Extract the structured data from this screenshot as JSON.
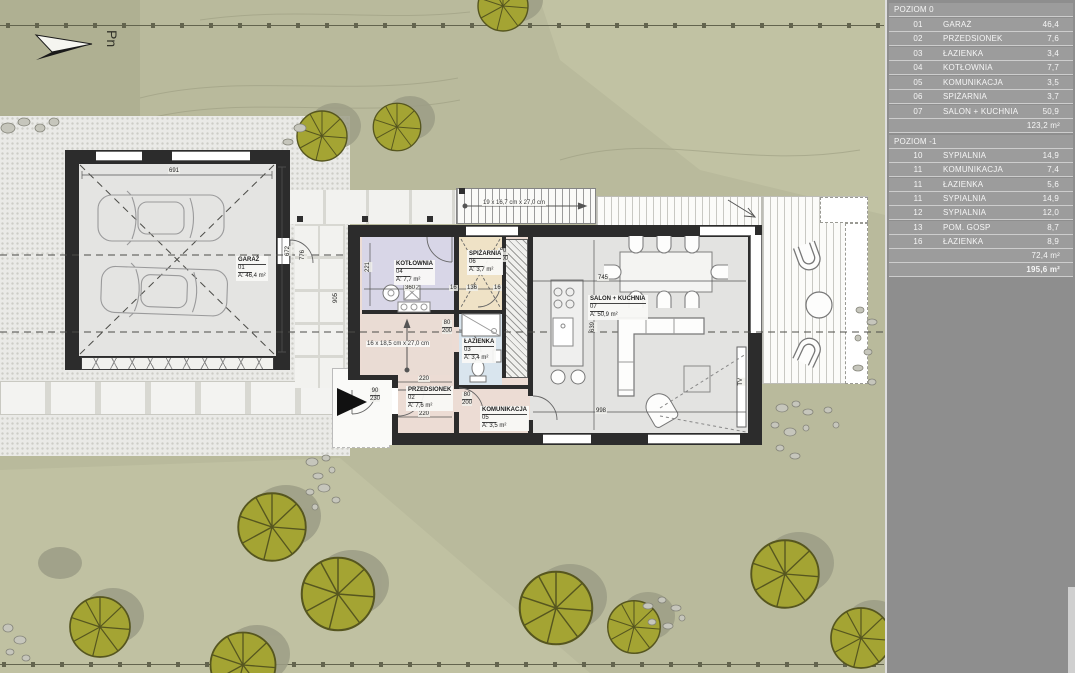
{
  "north": {
    "label": "Pn"
  },
  "legend": {
    "level0": {
      "title": "POZIOM 0",
      "rows": [
        {
          "no": "01",
          "name": "GARAŻ",
          "area": "46,4"
        },
        {
          "no": "02",
          "name": "PRZEDSIONEK",
          "area": "7,6"
        },
        {
          "no": "03",
          "name": "ŁAZIENKA",
          "area": "3,4"
        },
        {
          "no": "04",
          "name": "KOTŁOWNIA",
          "area": "7,7"
        },
        {
          "no": "05",
          "name": "KOMUNIKACJA",
          "area": "3,5"
        },
        {
          "no": "06",
          "name": "SPIŻARNIA",
          "area": "3,7"
        },
        {
          "no": "07",
          "name": "SALON + KUCHNIA",
          "area": "50,9"
        }
      ],
      "total": "123,2 m²"
    },
    "level_minus1": {
      "title": "POZIOM -1",
      "rows": [
        {
          "no": "10",
          "name": "SYPIALNIA",
          "area": "14,9"
        },
        {
          "no": "11",
          "name": "KOMUNIKACJA",
          "area": "7,4"
        },
        {
          "no": "11",
          "name": "ŁAZIENKA",
          "area": "5,6"
        },
        {
          "no": "11",
          "name": "SYPIALNIA",
          "area": "14,9"
        },
        {
          "no": "12",
          "name": "SYPIALNIA",
          "area": "12,0"
        },
        {
          "no": "13",
          "name": "POM. GOSP",
          "area": "8,7"
        },
        {
          "no": "16",
          "name": "ŁAZIENKA",
          "area": "8,9"
        }
      ],
      "total": "72,4 m²"
    },
    "grand_total": "195,6 m²"
  },
  "plan": {
    "rooms": [
      {
        "name": "GARAŻ",
        "no": "01",
        "area": "A: 46,4 m²"
      },
      {
        "name": "PRZEDSIONEK",
        "no": "02",
        "area": "A: 7,6 m²"
      },
      {
        "name": "ŁAZIENKA",
        "no": "03",
        "area": "A: 3,4 m²"
      },
      {
        "name": "KOTŁOWNIA",
        "no": "04",
        "area": "A: 7,7 m²"
      },
      {
        "name": "KOMUNIKACJA",
        "no": "05",
        "area": "A: 3,5 m²"
      },
      {
        "name": "SPIŻARNIA",
        "no": "06",
        "area": "A: 3,7 m²"
      },
      {
        "name": "SALON + KUCHNIA",
        "no": "07",
        "area": "A: 50,9 m²"
      }
    ],
    "stairs_internal_label": "16 x 18,5 cm x 27,0 cm",
    "stairs_external_label": "19 x 16,7 cm x 27,0 cm",
    "dims": {
      "garage_width": "691",
      "garage_height": "672",
      "kotlownia_width": "360",
      "kotlownia_height": "221",
      "spizarnia_width": "136",
      "wall_a": "16",
      "wall_b": "16",
      "salon_width": "745",
      "salon_height": "639",
      "salon_bottom_width": "998",
      "hall_width_top": "220",
      "hall_width_bottom": "220",
      "walkway_height": "776",
      "walkway_length": "905",
      "door_width": "80",
      "door_height": "200",
      "entry_door_width": "90",
      "entry_door_height": "230",
      "tv": "TV"
    }
  },
  "colors": {
    "site": "#b9ba9c",
    "panel": "#8e8e8e",
    "wall": "#2c2c2c",
    "room_pink": "#ecdcd4",
    "room_lavender": "#d8d6e7",
    "room_tan": "#efe2c6",
    "room_blue": "#d9e5ee",
    "room_gray": "#e3e3e1",
    "tree": "#a4a433",
    "tree_shadow": "#9c9d86",
    "paving": "#eaeae7"
  }
}
